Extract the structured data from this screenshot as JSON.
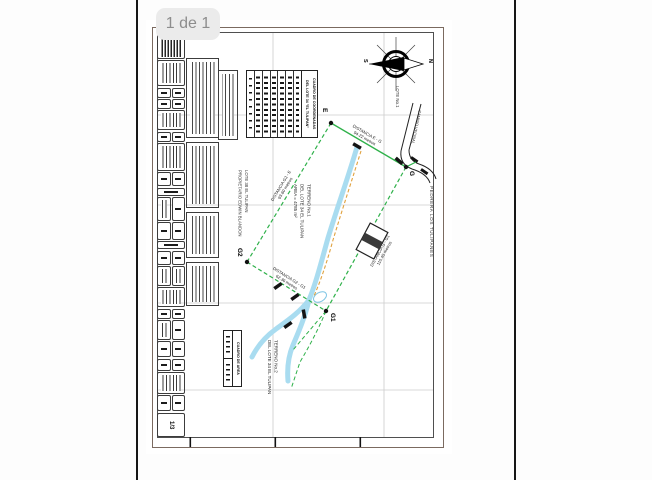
{
  "viewer": {
    "page_indicator": "1 de 1"
  },
  "page": {
    "sheet_number": "1/3"
  },
  "compass": {
    "north_label": "N",
    "south_label": "S"
  },
  "map": {
    "points": {
      "e": "E",
      "g": "G",
      "g1": "G1",
      "g2": "G2"
    },
    "labels": {
      "lote1": "LOTE No.1",
      "camino": "CAMINO VECINAL",
      "pedrera": "PEDRERA LOS TULIPANES",
      "lote38_l1": "LOTE 38 EL TULIPAN",
      "lote38_l2": "PROPIETARIO EDWIN BLANDON",
      "terreno1_l1": "TERRENO No.1",
      "terreno1_l2": "DEL LOTE 34 EL TULIPAN",
      "terreno1_l3": "AREA = 4785 m²",
      "terreno2_l1": "TERRENO No.2",
      "terreno2_l2": "DEL LOTE 34 EL TULIPAN"
    },
    "distances": [
      {
        "label": "DISTANCIA E - G",
        "value": "94.22 metros"
      },
      {
        "label": "DISTANCIA G2 - E",
        "value": "93.60 metros"
      },
      {
        "label": "DISTANCIA G - G1",
        "value": "110.45 metros"
      },
      {
        "label": "DISTANCIA G2 - G1",
        "value": "62.36 metros"
      }
    ]
  },
  "tables": {
    "coordinates": {
      "title": "CUADRO DE COORDENADAS",
      "subtitle": "DEL LOTE 34 \"EL TULIPAN\""
    },
    "area": {
      "title": "CUADRO DE AREA"
    }
  },
  "colors": {
    "boundary_green": "#2fb14a",
    "stream_blue": "#a9dcf0",
    "trail_orange": "#e0a23f",
    "road_ink": "#222222",
    "grid_gray": "#cccccc",
    "pill_bg": "#ebebeb",
    "pill_text": "#8d8d8d"
  }
}
